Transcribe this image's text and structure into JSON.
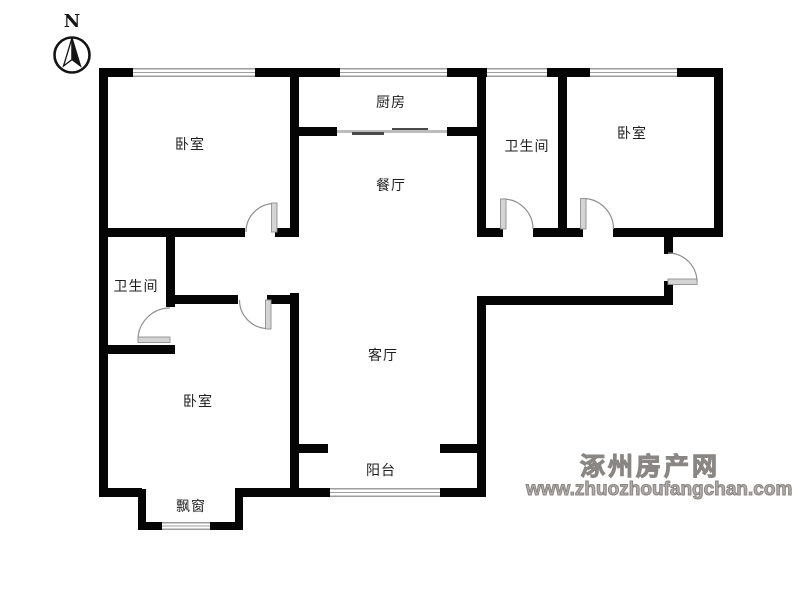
{
  "compass": {
    "label": "N"
  },
  "rooms": [
    {
      "name": "bedroom-top-left",
      "label": "卧室"
    },
    {
      "name": "kitchen",
      "label": "厨房"
    },
    {
      "name": "dining-room",
      "label": "餐厅"
    },
    {
      "name": "bathroom-top",
      "label": "卫生间"
    },
    {
      "name": "bedroom-top-right",
      "label": "卧室"
    },
    {
      "name": "bathroom-left",
      "label": "卫生间"
    },
    {
      "name": "living-room",
      "label": "客厅"
    },
    {
      "name": "bedroom-bottom-left",
      "label": "卧室"
    },
    {
      "name": "balcony",
      "label": "阳台"
    },
    {
      "name": "bay-window",
      "label": "飘窗"
    }
  ],
  "watermark": {
    "site_name": "涿州房产网",
    "site_url": "www.zhuozhoufangchan.com"
  },
  "colors": {
    "wall": "#050505",
    "window_line": "#9e9e9e",
    "door": "#8c8c8c",
    "door_leaf": "#d4d4d4",
    "watermark": "#9b9b9b",
    "label_text": "#1f1f1f",
    "background": "#ffffff"
  }
}
